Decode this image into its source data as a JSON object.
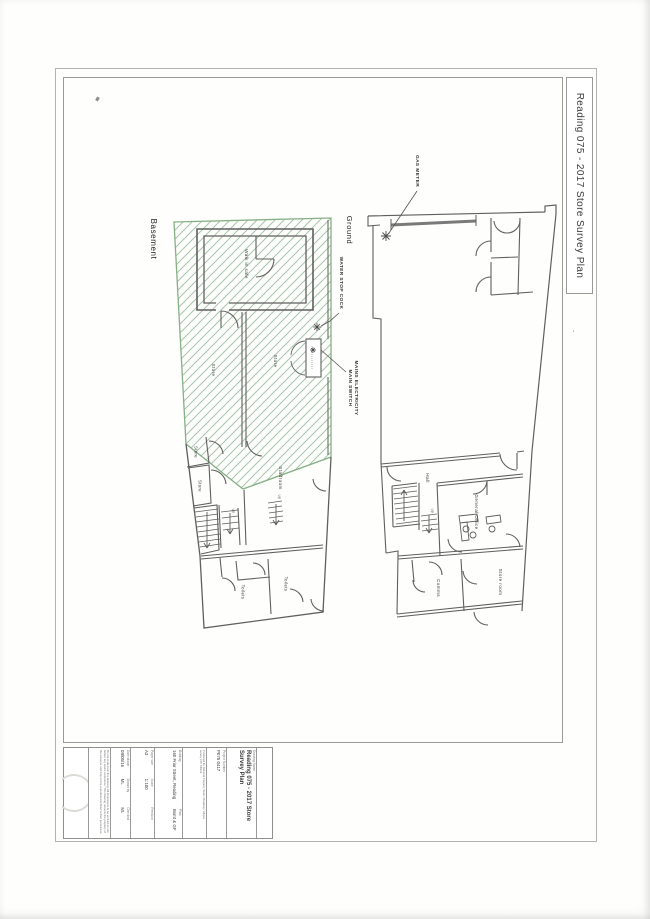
{
  "sheet": {
    "banner_title": "Reading 075 - 2017 Store Survey Plan"
  },
  "plan_labels": [
    {
      "name": "basement-title",
      "text": "Basement",
      "x": 153,
      "y": 239,
      "fs": 8,
      "bold": false,
      "big": true
    },
    {
      "name": "ground-title",
      "text": "Ground",
      "x": 349,
      "y": 230,
      "fs": 7.5,
      "bold": false,
      "big": true
    },
    {
      "name": "room-walk-in-safe",
      "text": "Walk in safe",
      "x": 246,
      "y": 264,
      "fs": 4.6
    },
    {
      "name": "room-store-basement-left",
      "text": "Store",
      "x": 213,
      "y": 370,
      "fs": 4.6
    },
    {
      "name": "room-store-basement-right",
      "text": "Store",
      "x": 275,
      "y": 361,
      "fs": 4.6
    },
    {
      "name": "room-store-small-upper",
      "text": "Store",
      "x": 196,
      "y": 452,
      "fs": 4.2
    },
    {
      "name": "room-store-small-lower",
      "text": "Store",
      "x": 200,
      "y": 486,
      "fs": 4.2
    },
    {
      "name": "room-staffroom",
      "text": "Staffroom",
      "x": 280,
      "y": 478,
      "fs": 4.6
    },
    {
      "name": "room-toilets-left",
      "text": "Toilets",
      "x": 243,
      "y": 592,
      "fs": 4.2
    },
    {
      "name": "room-toilets-right",
      "text": "Toilets",
      "x": 286,
      "y": 584,
      "fs": 4.2
    },
    {
      "name": "room-hall",
      "text": "Hall",
      "x": 427,
      "y": 478,
      "fs": 4.6
    },
    {
      "name": "room-general-office",
      "text": "General Office",
      "x": 476,
      "y": 512,
      "fs": 4.6
    },
    {
      "name": "room-comms",
      "text": "Comms",
      "x": 438,
      "y": 588,
      "fs": 4.6
    },
    {
      "name": "room-store-room",
      "text": "Store room",
      "x": 500,
      "y": 582,
      "fs": 4.6
    },
    {
      "name": "annotation-gas-meter",
      "text": "GAS METER",
      "x": 416,
      "y": 171,
      "fs": 4.8,
      "bold": true
    },
    {
      "name": "annotation-water-stop-cock",
      "text": "WATER STOP COCK",
      "x": 340,
      "y": 283,
      "fs": 4.8,
      "bold": true
    },
    {
      "name": "annotation-mains-electricity",
      "text": "MAINS ELECTRICITY\nMAIN SWITCH",
      "x": 352,
      "y": 388,
      "fs": 4.8,
      "bold": true
    },
    {
      "name": "stair-up-basement",
      "text": "up",
      "x": 233,
      "y": 511,
      "fs": 3.6
    },
    {
      "name": "stair-up-staffroom",
      "text": "up",
      "x": 279,
      "y": 497,
      "fs": 3.6
    },
    {
      "name": "stair-up-ground",
      "text": "up",
      "x": 432,
      "y": 511,
      "fs": 3.6
    }
  ],
  "title_block": {
    "drawing_name_label": "Drawing Name",
    "drawing_name": "Reading 075 - 2017 Store Survey Plan",
    "project_number_label": "Project Number",
    "project_number": "P075 0417",
    "notes_line1": "Produced for National Property Team / Reading / offices",
    "notes_line2": "survey 075 T/Bsmt",
    "building_label": "Building",
    "building": "160 Friar Street, Reading",
    "plan_label": "Plan",
    "plan": "Bsmt & GF",
    "paper_label": "Paper size",
    "paper": "A3",
    "scale_label": "Scale",
    "scale": "1:100",
    "revision_label": "Revision",
    "revision": "",
    "date_label": "Date drawn",
    "date": "09/05/16",
    "drawn_label": "Drawn by",
    "drawn": "ML",
    "checked_label": "Checked",
    "checked": "ML",
    "disclaimer": "Do not scale from this drawing. All dimensions to be verified on site before any works commence. This drawing remains the property of the surveyor and may not be reproduced without written permission."
  },
  "colors": {
    "wall": "#5f5f5f",
    "hatch_line": "#a8c6a8",
    "hatch_edge": "#85b085",
    "frame": "#9a9a98"
  }
}
